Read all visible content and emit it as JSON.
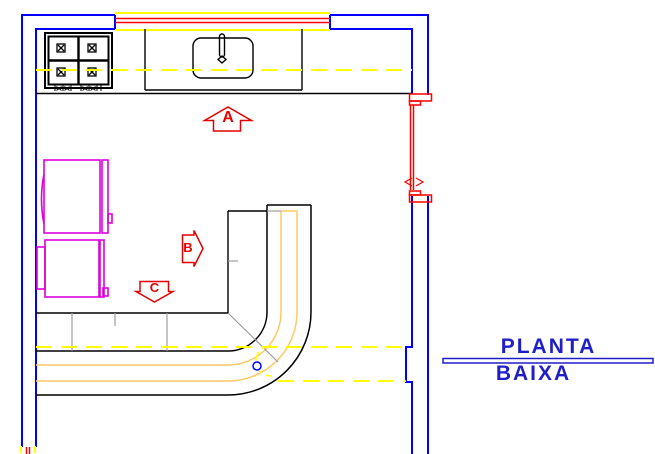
{
  "drawing": {
    "title_line1": "PLANTA",
    "title_line2": "BAIXA",
    "section_arrows": {
      "a": "A",
      "b": "B",
      "c": "C"
    },
    "colors": {
      "wall": "#0000FF",
      "window_frame": "#FFFF00",
      "window_glass": "#FF0000",
      "door": "#FF0000",
      "centerline": "#FFFF00",
      "counter_outline": "#000000",
      "counter_edge_detail": "#FFC966",
      "cabinet_divider": "#9C9C9C",
      "appliance": "#DD00DD",
      "section_arrow": "#E30000",
      "title_text": "#1F1FC8",
      "drain_circle": "#0000FF"
    }
  }
}
